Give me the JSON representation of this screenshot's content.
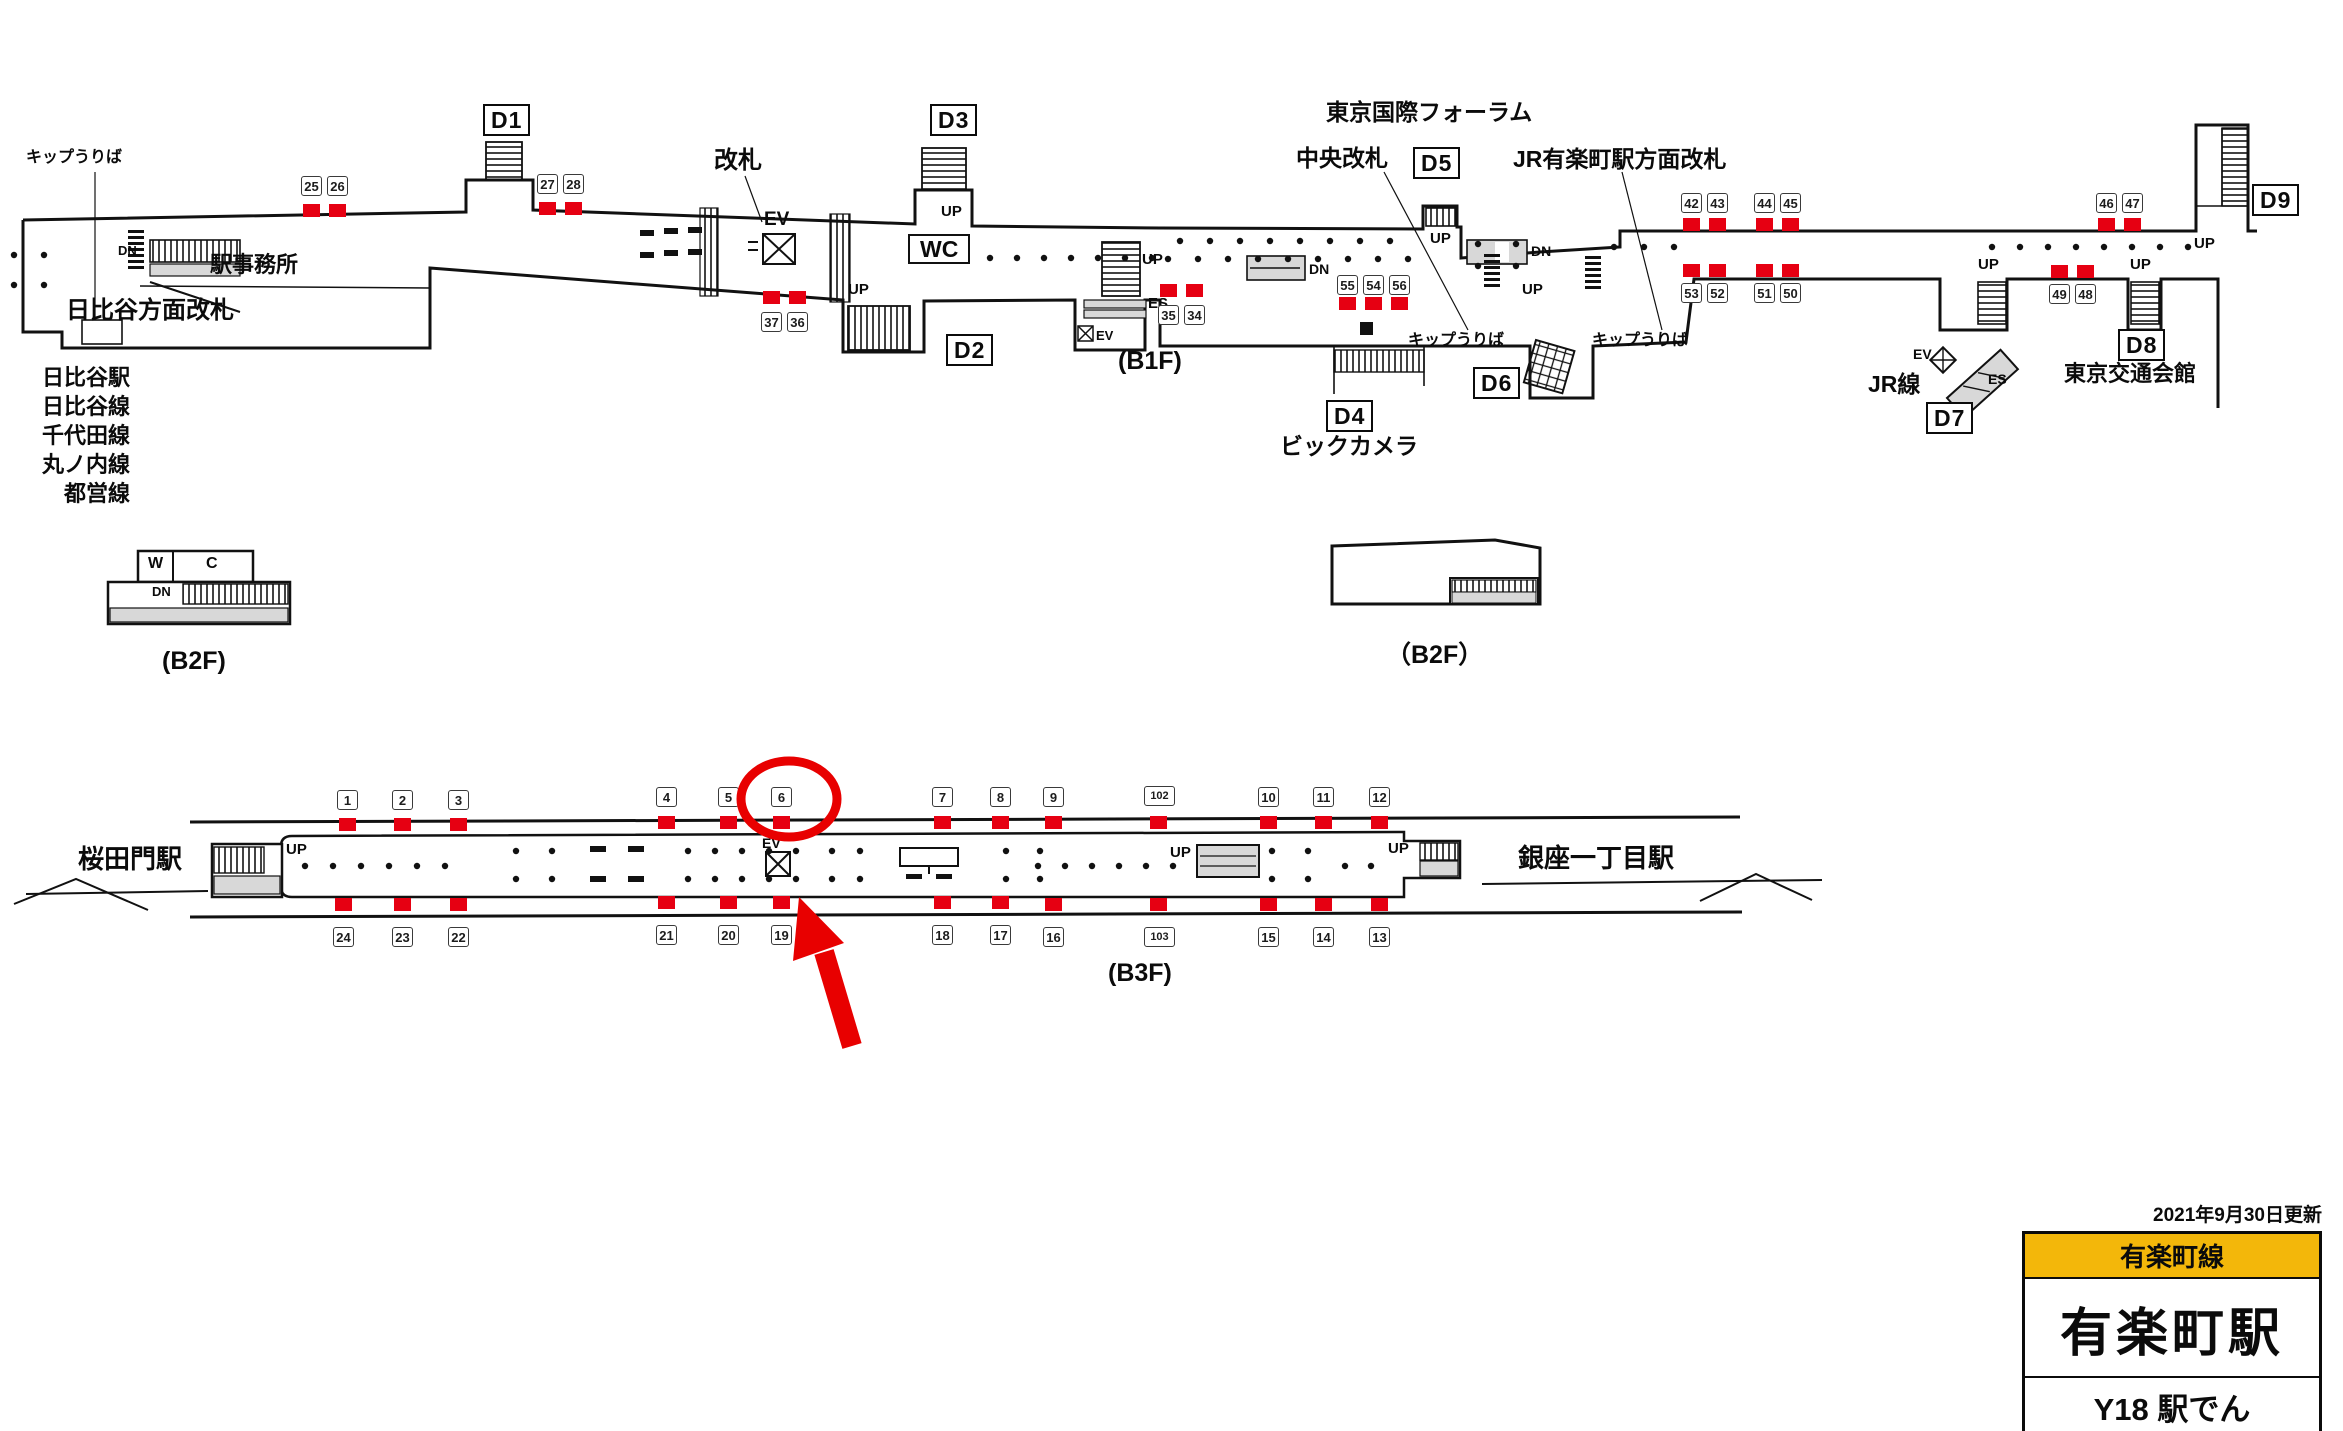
{
  "info_panel": {
    "updated": "2021年9月30日更新",
    "line": "有楽町線",
    "station": "有楽町駅",
    "code_row": "Y18 駅でん"
  },
  "colors": {
    "red": "#e60012",
    "annotation": "#e80000",
    "yellow": "#f3b70a",
    "ink": "#111111",
    "gray": "#d8d8d8"
  },
  "legend_left": {
    "items": [
      "日比谷駅",
      "日比谷線",
      "千代田線",
      "丸ノ内線",
      "都営線"
    ]
  },
  "b1f": {
    "exits": [
      {
        "label": "D1",
        "x": 483,
        "y": 104
      },
      {
        "label": "D2",
        "x": 946,
        "y": 334
      },
      {
        "label": "D3",
        "x": 930,
        "y": 104
      },
      {
        "label": "D4",
        "x": 1326,
        "y": 400
      },
      {
        "label": "D5",
        "x": 1413,
        "y": 147
      },
      {
        "label": "D6",
        "x": 1473,
        "y": 367
      },
      {
        "label": "D7",
        "x": 1926,
        "y": 402
      },
      {
        "label": "D8",
        "x": 2118,
        "y": 329
      },
      {
        "label": "D9",
        "x": 2252,
        "y": 184
      }
    ],
    "signs": [
      {
        "n": "25",
        "x": 301,
        "y": 176,
        "qx": 303,
        "qy": 204
      },
      {
        "n": "26",
        "x": 327,
        "y": 176,
        "qx": 329,
        "qy": 204
      },
      {
        "n": "27",
        "x": 537,
        "y": 174,
        "qx": 539,
        "qy": 202
      },
      {
        "n": "28",
        "x": 563,
        "y": 174,
        "qx": 565,
        "qy": 202
      },
      {
        "n": "37",
        "x": 761,
        "y": 312,
        "qx": 763,
        "qy": 291
      },
      {
        "n": "36",
        "x": 787,
        "y": 312,
        "qx": 789,
        "qy": 291
      },
      {
        "n": "35",
        "x": 1158,
        "y": 305,
        "qx": 1160,
        "qy": 284
      },
      {
        "n": "34",
        "x": 1184,
        "y": 305,
        "qx": 1186,
        "qy": 284
      },
      {
        "n": "55",
        "x": 1337,
        "y": 275,
        "qx": 1339,
        "qy": 297
      },
      {
        "n": "54",
        "x": 1363,
        "y": 275,
        "qx": 1365,
        "qy": 297
      },
      {
        "n": "56",
        "x": 1389,
        "y": 275,
        "qx": 1391,
        "qy": 297
      },
      {
        "n": "42",
        "x": 1681,
        "y": 193,
        "qx": 1683,
        "qy": 218
      },
      {
        "n": "43",
        "x": 1707,
        "y": 193,
        "qx": 1709,
        "qy": 218
      },
      {
        "n": "44",
        "x": 1754,
        "y": 193,
        "qx": 1756,
        "qy": 218
      },
      {
        "n": "45",
        "x": 1780,
        "y": 193,
        "qx": 1782,
        "qy": 218
      },
      {
        "n": "46",
        "x": 2096,
        "y": 193,
        "qx": 2098,
        "qy": 218
      },
      {
        "n": "47",
        "x": 2122,
        "y": 193,
        "qx": 2124,
        "qy": 218
      },
      {
        "n": "53",
        "x": 1681,
        "y": 283,
        "qx": 1683,
        "qy": 264
      },
      {
        "n": "52",
        "x": 1707,
        "y": 283,
        "qx": 1709,
        "qy": 264
      },
      {
        "n": "51",
        "x": 1754,
        "y": 283,
        "qx": 1756,
        "qy": 264
      },
      {
        "n": "50",
        "x": 1780,
        "y": 283,
        "qx": 1782,
        "qy": 264
      },
      {
        "n": "49",
        "x": 2049,
        "y": 284,
        "qx": 2051,
        "qy": 265
      },
      {
        "n": "48",
        "x": 2075,
        "y": 284,
        "qx": 2077,
        "qy": 265
      }
    ],
    "labels": [
      {
        "t": "キップうりば",
        "x": 26,
        "y": 150,
        "s": 16,
        "id": "ticket-sales-label"
      },
      {
        "t": "DN",
        "x": 118,
        "y": 244,
        "s": 13
      },
      {
        "t": "駅事務所",
        "x": 210,
        "y": 253,
        "s": 22,
        "id": "station-office-label"
      },
      {
        "t": "日比谷方面改札",
        "x": 66,
        "y": 298,
        "s": 24,
        "id": "hibiya-gate-label"
      },
      {
        "t": "改札",
        "x": 714,
        "y": 148,
        "s": 24,
        "id": "kaisatsu-label"
      },
      {
        "t": "EV",
        "x": 764,
        "y": 210,
        "s": 19
      },
      {
        "t": "WC",
        "x": 908,
        "y": 234,
        "s": 23,
        "boxed": true,
        "id": "wc-label"
      },
      {
        "t": "UP",
        "x": 941,
        "y": 204,
        "s": 15
      },
      {
        "t": "UP",
        "x": 848,
        "y": 282,
        "s": 15
      },
      {
        "t": "(B1F)",
        "x": 1118,
        "y": 348,
        "s": 25,
        "id": "floor-label-b1f"
      },
      {
        "t": "UP",
        "x": 1142,
        "y": 252,
        "s": 15
      },
      {
        "t": "ES",
        "x": 1148,
        "y": 296,
        "s": 15
      },
      {
        "t": "EV",
        "x": 1096,
        "y": 329,
        "s": 13
      },
      {
        "t": "DN",
        "x": 1309,
        "y": 262,
        "s": 14
      },
      {
        "t": "東京国際フォーラム",
        "x": 1326,
        "y": 100,
        "s": 23,
        "id": "tokyo-forum-label"
      },
      {
        "t": "中央改札",
        "x": 1296,
        "y": 146,
        "s": 23,
        "id": "central-gate-label"
      },
      {
        "t": "JR有楽町駅方面改札",
        "x": 1513,
        "y": 147,
        "s": 23,
        "id": "jr-gate-label"
      },
      {
        "t": "UP",
        "x": 1430,
        "y": 231,
        "s": 15
      },
      {
        "t": "DN",
        "x": 1531,
        "y": 244,
        "s": 14
      },
      {
        "t": "UP",
        "x": 1522,
        "y": 282,
        "s": 15
      },
      {
        "t": "キップうりば",
        "x": 1408,
        "y": 333,
        "s": 16,
        "id": "ticket-sales-label"
      },
      {
        "t": "キップうりば",
        "x": 1592,
        "y": 333,
        "s": 16,
        "id": "ticket-sales-label"
      },
      {
        "t": "ビックカメラ",
        "x": 1280,
        "y": 434,
        "s": 23,
        "id": "bic-camera-label"
      },
      {
        "t": "JR線",
        "x": 1868,
        "y": 372,
        "s": 23,
        "id": "jr-line-label"
      },
      {
        "t": "EV",
        "x": 1913,
        "y": 347,
        "s": 14
      },
      {
        "t": "ES",
        "x": 1988,
        "y": 372,
        "s": 14
      },
      {
        "t": "UP",
        "x": 1978,
        "y": 257,
        "s": 15
      },
      {
        "t": "UP",
        "x": 2130,
        "y": 257,
        "s": 15
      },
      {
        "t": "UP",
        "x": 2194,
        "y": 236,
        "s": 15
      },
      {
        "t": "東京交通会館",
        "x": 2064,
        "y": 362,
        "s": 22,
        "id": "kotsu-kaikan-label"
      }
    ]
  },
  "b2f_left": {
    "labels": [
      {
        "t": "W",
        "x": 148,
        "y": 556,
        "s": 16
      },
      {
        "t": "C",
        "x": 206,
        "y": 556,
        "s": 16
      },
      {
        "t": "DN",
        "x": 152,
        "y": 585,
        "s": 13
      },
      {
        "t": "(B2F)",
        "x": 162,
        "y": 648,
        "s": 25,
        "id": "floor-label-b2f-left"
      }
    ]
  },
  "b2f_right": {
    "labels": [
      {
        "t": "（B2F）",
        "x": 1386,
        "y": 642,
        "s": 25,
        "id": "floor-label-b2f-right"
      }
    ]
  },
  "b3f": {
    "signs_top": [
      {
        "n": "1",
        "x": 337,
        "y": 790,
        "qx": 339,
        "qy": 818
      },
      {
        "n": "2",
        "x": 392,
        "y": 790,
        "qx": 394,
        "qy": 818
      },
      {
        "n": "3",
        "x": 448,
        "y": 790,
        "qx": 450,
        "qy": 818
      },
      {
        "n": "4",
        "x": 656,
        "y": 787,
        "qx": 658,
        "qy": 816
      },
      {
        "n": "5",
        "x": 718,
        "y": 787,
        "qx": 720,
        "qy": 816
      },
      {
        "n": "6",
        "x": 771,
        "y": 787,
        "qx": 773,
        "qy": 816
      },
      {
        "n": "7",
        "x": 932,
        "y": 787,
        "qx": 934,
        "qy": 816
      },
      {
        "n": "8",
        "x": 990,
        "y": 787,
        "qx": 992,
        "qy": 816
      },
      {
        "n": "9",
        "x": 1043,
        "y": 787,
        "qx": 1045,
        "qy": 816
      },
      {
        "n": "102",
        "x": 1144,
        "y": 786,
        "qx": 1150,
        "qy": 816
      },
      {
        "n": "10",
        "x": 1258,
        "y": 787,
        "qx": 1260,
        "qy": 816
      },
      {
        "n": "11",
        "x": 1313,
        "y": 787,
        "qx": 1315,
        "qy": 816
      },
      {
        "n": "12",
        "x": 1369,
        "y": 787,
        "qx": 1371,
        "qy": 816
      }
    ],
    "signs_bottom": [
      {
        "n": "24",
        "x": 333,
        "y": 927,
        "qx": 335,
        "qy": 898
      },
      {
        "n": "23",
        "x": 392,
        "y": 927,
        "qx": 394,
        "qy": 898
      },
      {
        "n": "22",
        "x": 448,
        "y": 927,
        "qx": 450,
        "qy": 898
      },
      {
        "n": "21",
        "x": 656,
        "y": 925,
        "qx": 658,
        "qy": 896
      },
      {
        "n": "20",
        "x": 718,
        "y": 925,
        "qx": 720,
        "qy": 896
      },
      {
        "n": "19",
        "x": 771,
        "y": 925,
        "qx": 773,
        "qy": 896
      },
      {
        "n": "18",
        "x": 932,
        "y": 925,
        "qx": 934,
        "qy": 896
      },
      {
        "n": "17",
        "x": 990,
        "y": 925,
        "qx": 992,
        "qy": 896
      },
      {
        "n": "16",
        "x": 1043,
        "y": 927,
        "qx": 1045,
        "qy": 898
      },
      {
        "n": "103",
        "x": 1144,
        "y": 927,
        "qx": 1150,
        "qy": 898
      },
      {
        "n": "15",
        "x": 1258,
        "y": 927,
        "qx": 1260,
        "qy": 898
      },
      {
        "n": "14",
        "x": 1313,
        "y": 927,
        "qx": 1315,
        "qy": 898
      },
      {
        "n": "13",
        "x": 1369,
        "y": 927,
        "qx": 1371,
        "qy": 898
      }
    ],
    "labels": [
      {
        "t": "桜田門駅",
        "x": 78,
        "y": 846,
        "s": 26,
        "id": "station-sakuradamon"
      },
      {
        "t": "UP",
        "x": 286,
        "y": 842,
        "s": 15
      },
      {
        "t": "EV",
        "x": 762,
        "y": 836,
        "s": 14
      },
      {
        "t": "UP",
        "x": 1170,
        "y": 845,
        "s": 15
      },
      {
        "t": "UP",
        "x": 1388,
        "y": 841,
        "s": 15
      },
      {
        "t": "銀座一丁目駅",
        "x": 1518,
        "y": 845,
        "s": 26,
        "id": "station-ginza-itchome"
      },
      {
        "t": "(B3F)",
        "x": 1108,
        "y": 960,
        "s": 25,
        "id": "floor-label-b3f"
      }
    ]
  },
  "annotation": {
    "highlighted_sign": "6"
  },
  "dotrows": [
    {
      "y": 255,
      "x0": 14,
      "n": 2,
      "dx": 30
    },
    {
      "y": 285,
      "x0": 14,
      "n": 2,
      "dx": 30
    },
    {
      "y": 258,
      "x0": 990,
      "n": 7,
      "dx": 27
    },
    {
      "y": 241,
      "x0": 1180,
      "n": 8,
      "dx": 30
    },
    {
      "y": 259,
      "x0": 1168,
      "n": 9,
      "dx": 30
    },
    {
      "y": 244,
      "x0": 1478,
      "n": 2,
      "dx": 38
    },
    {
      "y": 266,
      "x0": 1478,
      "n": 2,
      "dx": 38
    },
    {
      "y": 247,
      "x0": 1614,
      "n": 3,
      "dx": 30
    },
    {
      "y": 247,
      "x0": 1992,
      "n": 8,
      "dx": 28
    },
    {
      "y": 866,
      "x0": 305,
      "n": 6,
      "dx": 28
    },
    {
      "y": 851,
      "x0": 516,
      "n": 2,
      "dx": 36
    },
    {
      "y": 879,
      "x0": 516,
      "n": 2,
      "dx": 36
    },
    {
      "y": 851,
      "x0": 688,
      "n": 5,
      "dx": 27
    },
    {
      "y": 879,
      "x0": 688,
      "n": 5,
      "dx": 27
    },
    {
      "y": 851,
      "x0": 832,
      "n": 2,
      "dx": 28
    },
    {
      "y": 879,
      "x0": 832,
      "n": 2,
      "dx": 28
    },
    {
      "y": 851,
      "x0": 1006,
      "n": 2,
      "dx": 34
    },
    {
      "y": 879,
      "x0": 1006,
      "n": 2,
      "dx": 34
    },
    {
      "y": 866,
      "x0": 1038,
      "n": 6,
      "dx": 27
    },
    {
      "y": 851,
      "x0": 1272,
      "n": 2,
      "dx": 36
    },
    {
      "y": 879,
      "x0": 1272,
      "n": 2,
      "dx": 36
    },
    {
      "y": 866,
      "x0": 1345,
      "n": 2,
      "dx": 26
    }
  ]
}
